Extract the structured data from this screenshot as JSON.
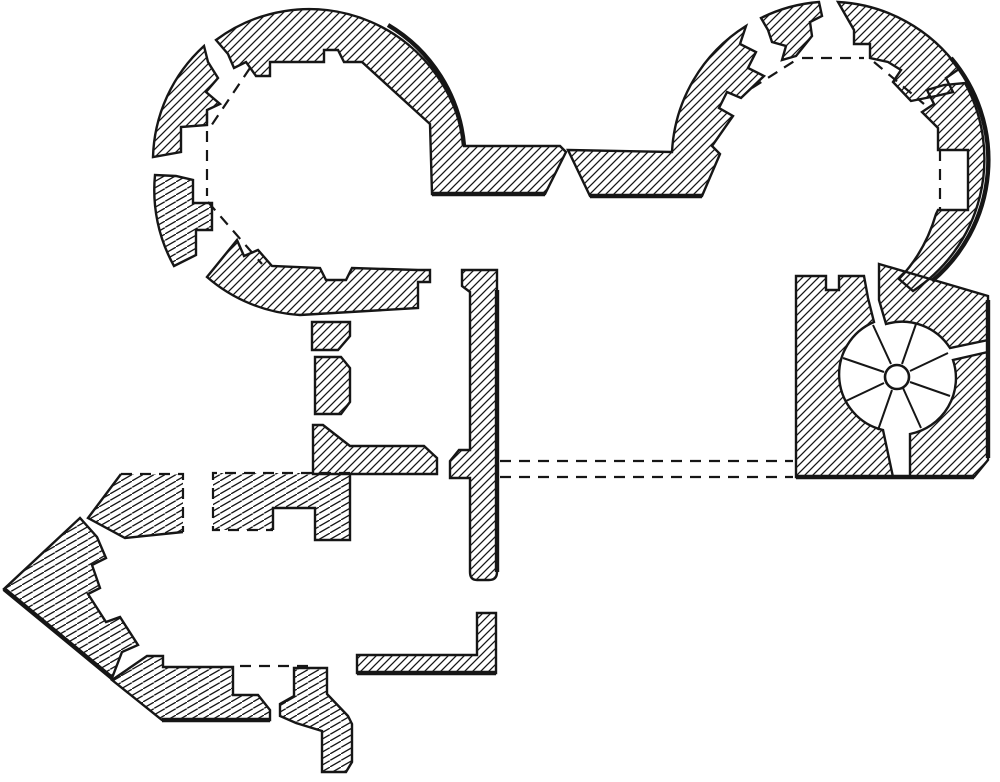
{
  "figure": {
    "kind": "engraved architectural floor plan",
    "subject": "Plan of a twin-towered castle gatehouse with spiral stair and pointed spur wall",
    "label": "Castle gatehouse floor plan"
  },
  "palette": {
    "ink": "#161616",
    "paper": "#ffffff"
  },
  "hatching": {
    "style": "diagonal line hatching on all masonry",
    "primary_angle_deg": 45,
    "secondary_angle_deg": 30,
    "spacing_px": 8
  },
  "elements": [
    {
      "id": "northwest-tower",
      "label": "Northwest round tower with polygonal inner chamber and stepped arrow-slit embrasures; dashed lines mark the embrasure openings"
    },
    {
      "id": "northeast-tower",
      "label": "Northeast round tower with notched inner wall, wall niche and dashed opening lines"
    },
    {
      "id": "gate-passage",
      "label": "Central entrance passage between the twin towers"
    },
    {
      "id": "central-walls",
      "label": "Inner courtyard spine wall with door piers; double dashed line marks a passage across the court"
    },
    {
      "id": "stair-block",
      "label": "Square stair block housing a newel spiral staircase"
    },
    {
      "id": "spiral-staircase",
      "label": "Spiral staircase with radiating treads around a circular newel"
    },
    {
      "id": "southwest-spur",
      "label": "Beak-shaped pointed spur wall and south curtain fragments, partly dashed where ruined"
    },
    {
      "id": "south-wall",
      "label": "L-shaped south wall fragment"
    }
  ],
  "spiral_stair": {
    "treads": 8,
    "newel": "circular"
  },
  "counts": {
    "northwest_tower_embrasure_gaps": 3,
    "northeast_tower_embrasure_gaps": 3,
    "wall_niches": 1
  }
}
